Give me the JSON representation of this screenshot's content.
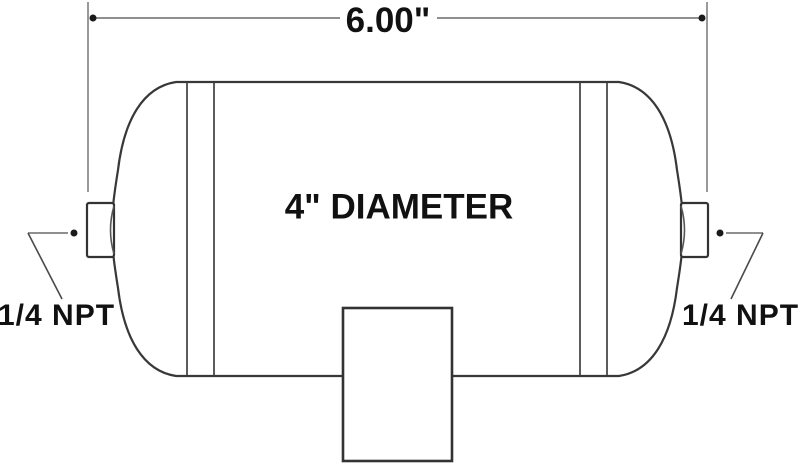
{
  "labels": {
    "length_dimension": "6.00\"",
    "diameter": "4\" DIAMETER",
    "npt_left": "1/4 NPT",
    "npt_right": "1/4 NPT"
  },
  "colors": {
    "background": "#ffffff",
    "tank_outline": "#383838",
    "dimension_line": "#8f8f8f",
    "leader_diagonal": "#4a4a4a",
    "arrow_dot": "#1a1a1a",
    "text": "#111111"
  }
}
